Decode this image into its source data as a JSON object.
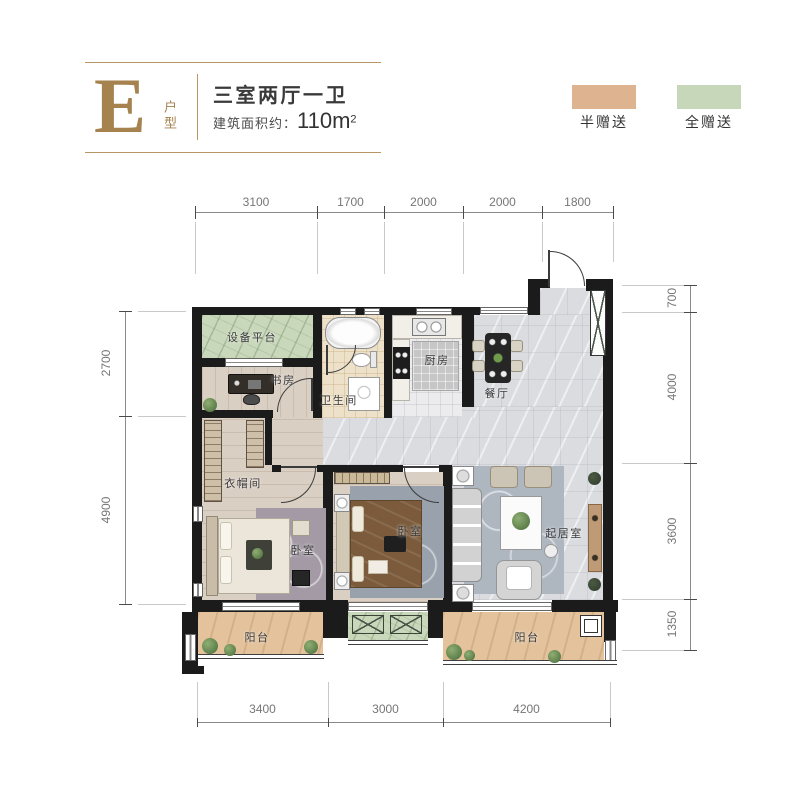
{
  "header": {
    "logo_letter": "E",
    "logo_sub": "户型",
    "title": "三室两厅一卫",
    "area_prefix": "建筑面积约：",
    "area_value": "110m",
    "area_sup": "2"
  },
  "legend": {
    "half": {
      "label": "半赠送",
      "color": "#ddb48f"
    },
    "full": {
      "label": "全赠送",
      "color": "#c7d8ba"
    }
  },
  "dims": {
    "top": [
      "3100",
      "1700",
      "2000",
      "2000",
      "1800"
    ],
    "left": [
      "2700",
      "4900"
    ],
    "right": [
      "700",
      "4000",
      "3600",
      "1350"
    ],
    "bottom": [
      "3400",
      "3000",
      "4200"
    ]
  },
  "rooms": {
    "equipment_platform": "设备平台",
    "study": "书房",
    "bathroom": "卫生间",
    "kitchen": "厨房",
    "dining": "餐厅",
    "cloakroom": "衣帽间",
    "bedroom_left": "卧室",
    "bedroom_mid": "卧室",
    "living": "起居室",
    "balcony_left": "阳台",
    "balcony_right": "阳台"
  },
  "colors": {
    "accent_gold": "#a5824e",
    "wall": "#1b1b1b",
    "gift_half": "#ddb48f",
    "gift_full": "#c7d8ba",
    "marble_floor": "#dadce0",
    "wood_floor": "#d9cfc3",
    "bath_tile": "#eee1c9",
    "balcony_floor": "#e3c29c",
    "dim_text": "#767676"
  }
}
